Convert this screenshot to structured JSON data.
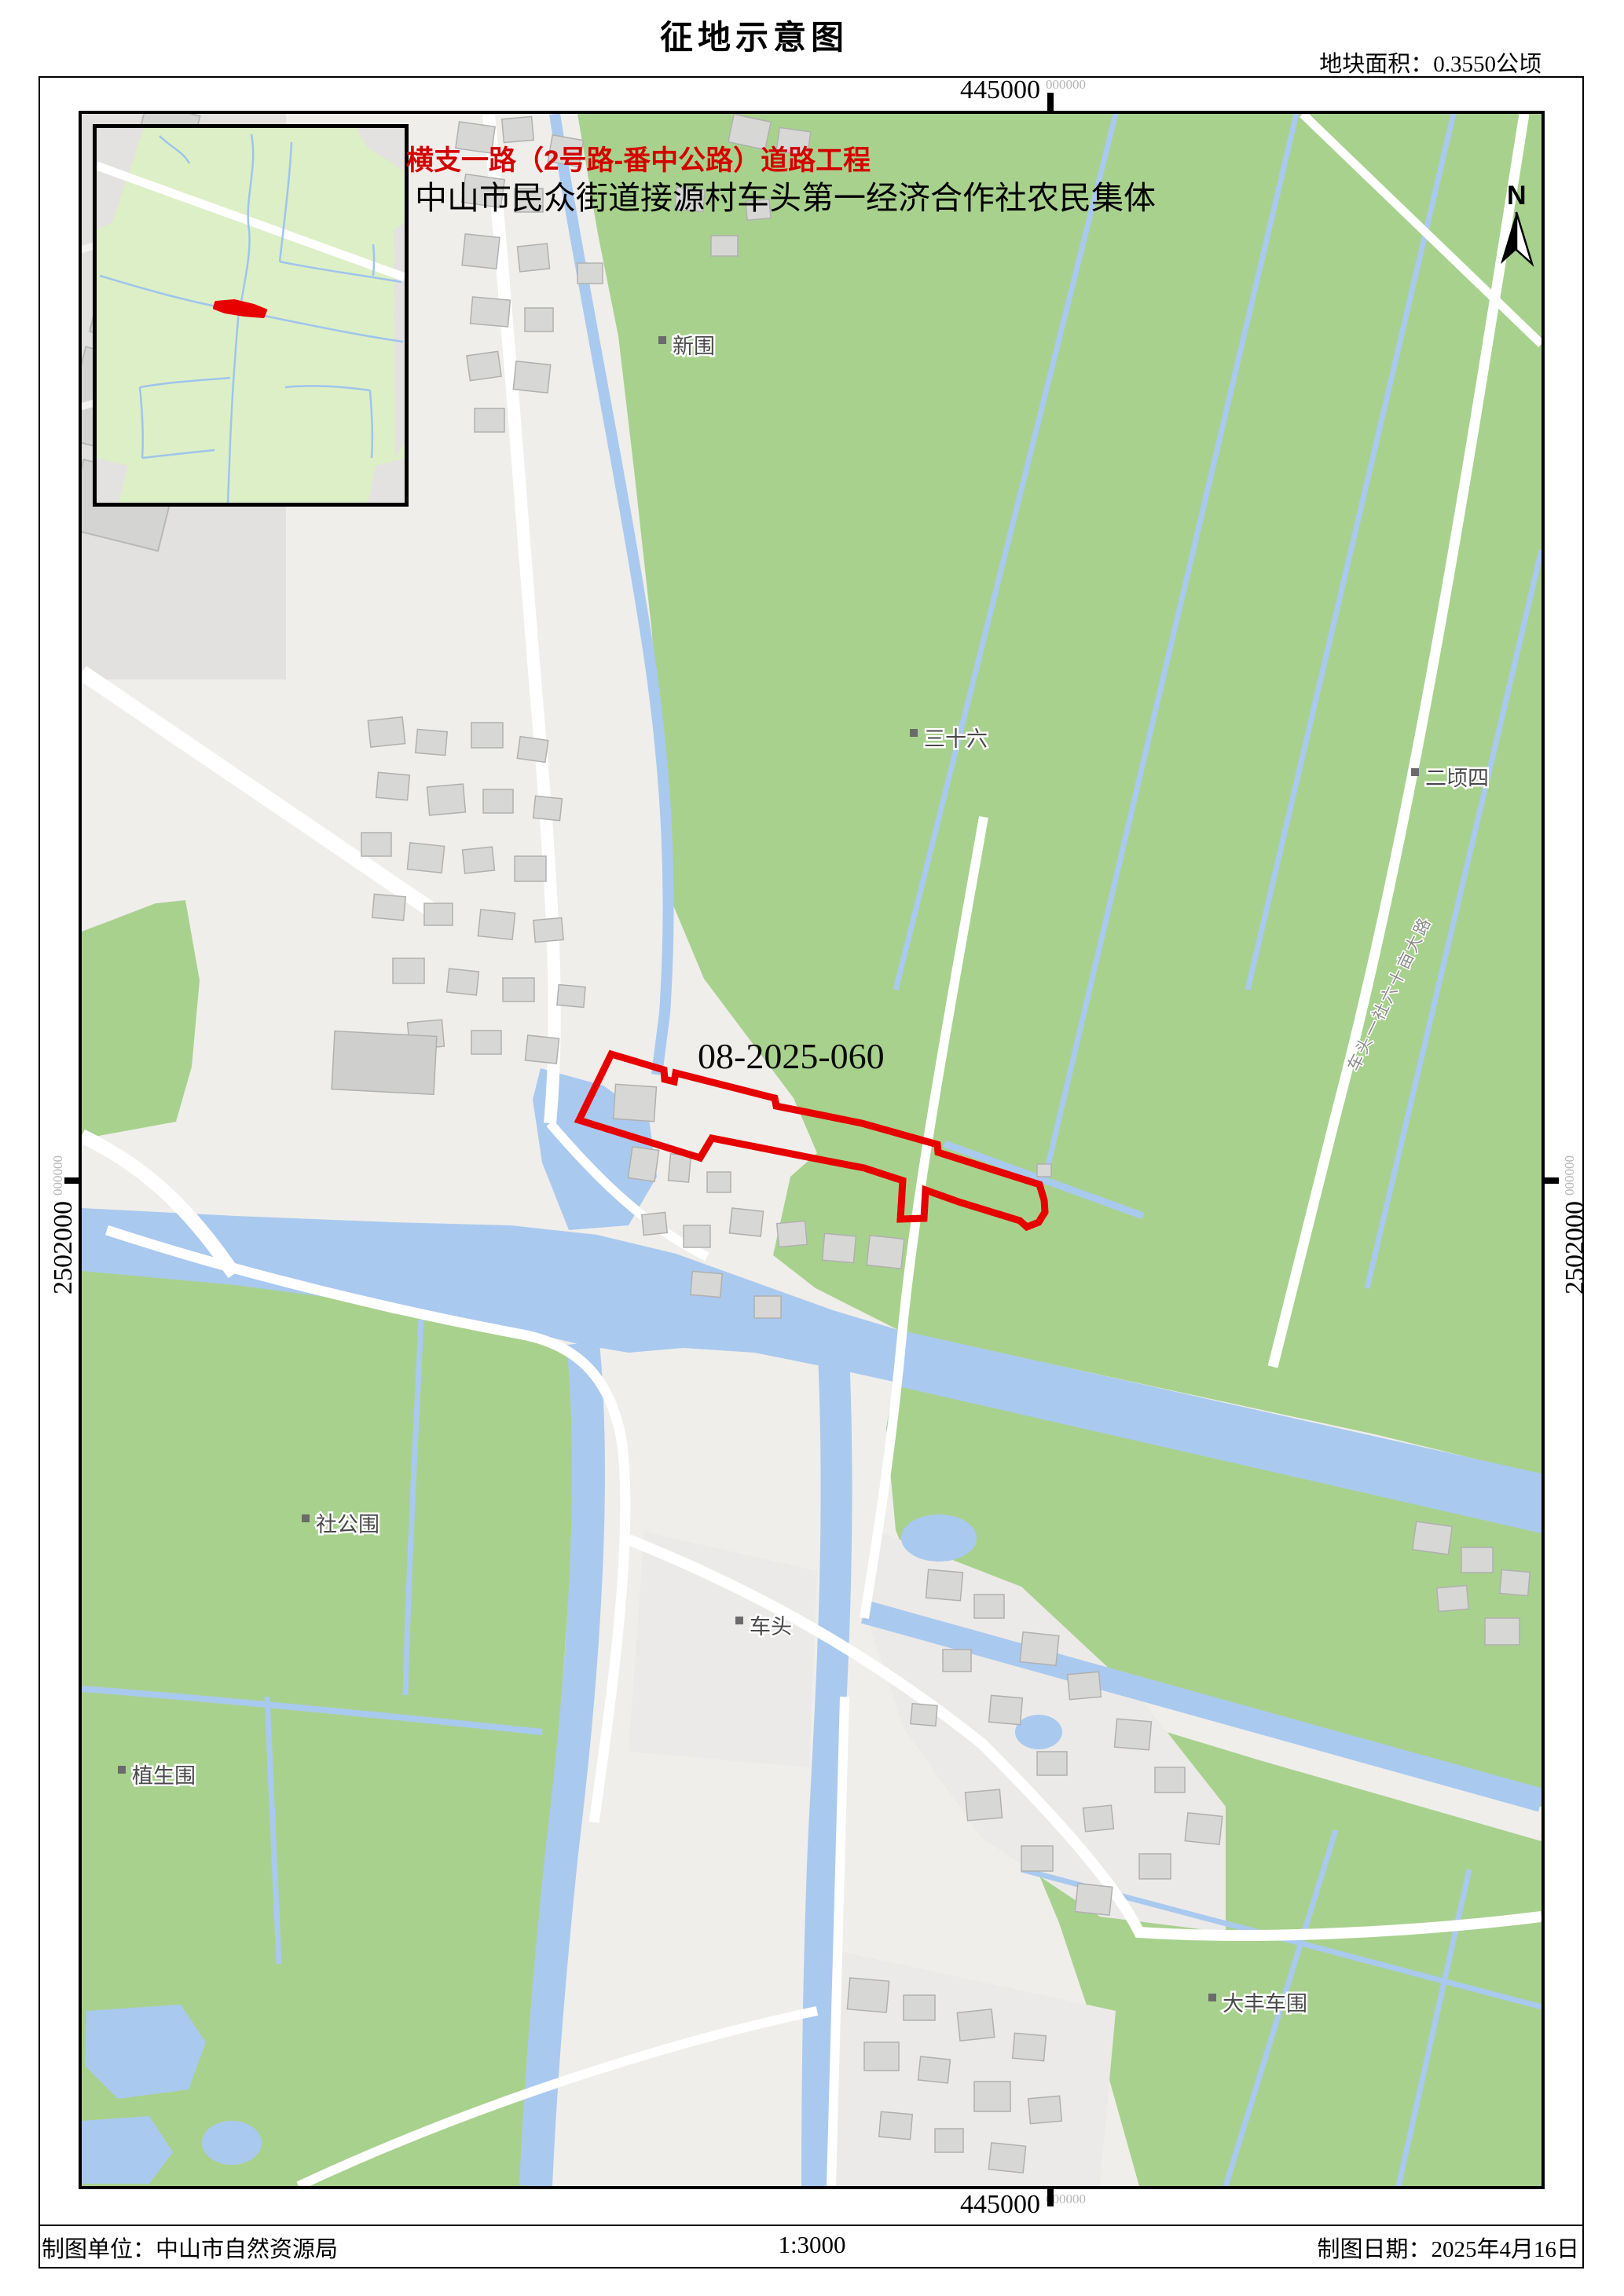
{
  "page": {
    "title": "征地示意图",
    "area_note": "地块面积：0.3550公顷"
  },
  "annotations": {
    "project": "横支一路（2号路-番中公路）道路工程",
    "owner": "中山市民众街道接源村车头第一经济合作社农民集体",
    "parcel_code": "08-2025-060"
  },
  "coordinates": {
    "x_top": "445000",
    "x_top_sup": "000000",
    "x_bottom": "445000",
    "x_bottom_sup": "000000",
    "y_left": "2502000",
    "y_left_sup": "000000",
    "y_right": "2502000",
    "y_right_sup": "000000"
  },
  "north": {
    "label": "N"
  },
  "map": {
    "place_labels": [
      {
        "name": "新围"
      },
      {
        "name": "三十六"
      },
      {
        "name": "二顷四"
      },
      {
        "name": "社公围"
      },
      {
        "name": "车头"
      },
      {
        "name": "植生围"
      },
      {
        "name": "大丰车围"
      }
    ],
    "road_label": "车头一社六十亩大路"
  },
  "footer": {
    "agency": "制图单位：中山市自然资源局",
    "scale": "1:3000",
    "date": "制图日期：2025年4月16日"
  },
  "colors": {
    "parcel_outline": "#e60000",
    "field_green": "#a9d18e",
    "water_blue": "#aac9ef",
    "heading_red": "#d40000",
    "inset_green": "#ddefc6"
  }
}
